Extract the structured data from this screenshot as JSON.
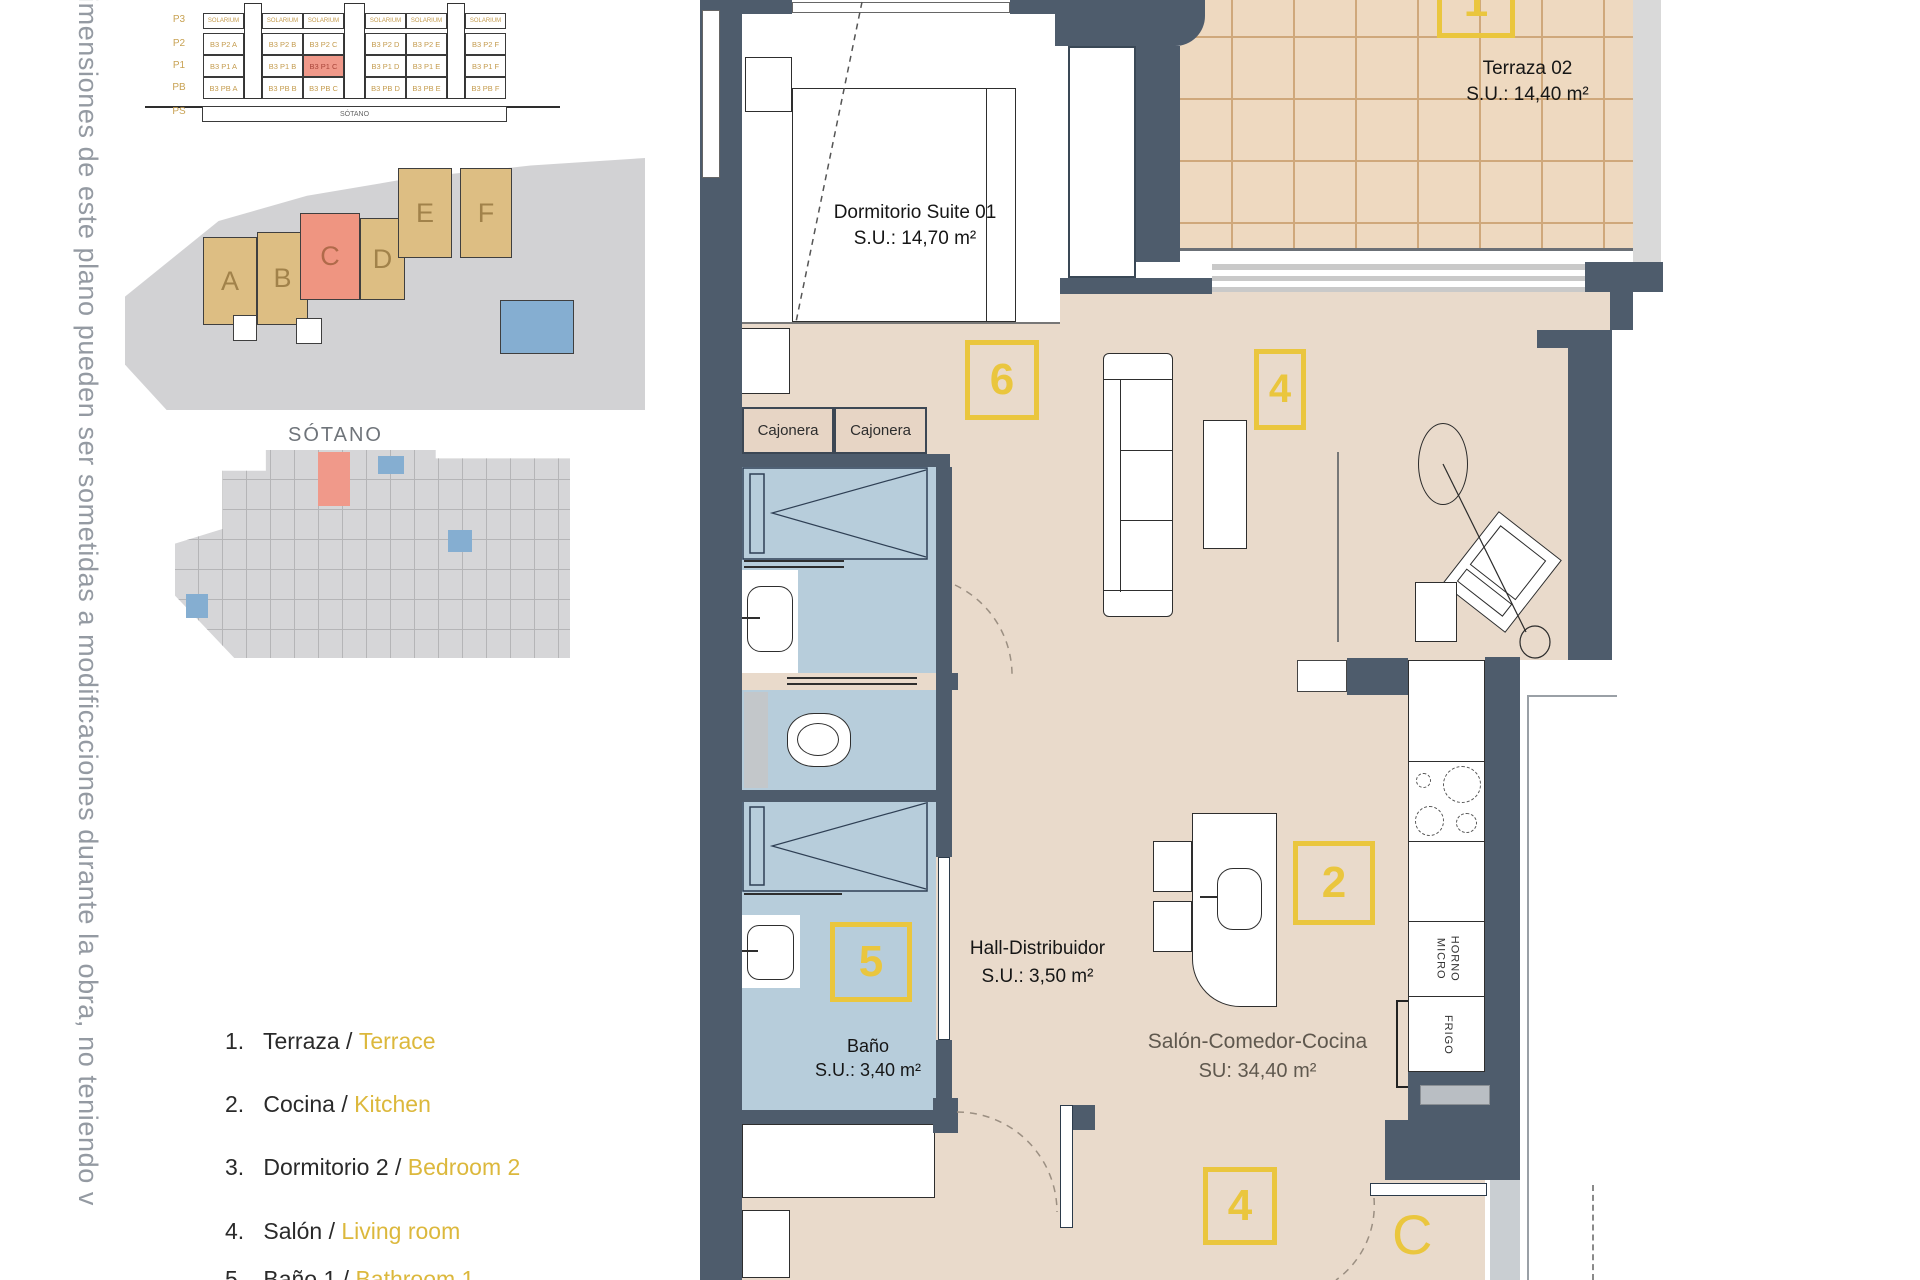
{
  "note_vertical": "imensiones de este plano pueden ser sometidas a modificaciones durante la obra, no teniendo v",
  "elevation": {
    "row_labels": [
      "P3",
      "P2",
      "P1",
      "PB",
      "PS"
    ],
    "solarium": "SOLARIUM",
    "sotano": "SÓTANO",
    "p2": [
      "B3 P2 A",
      "B3 P2 B",
      "B3 P2 C",
      "B3 P2 D",
      "B3 P2 E",
      "B3 P2 F"
    ],
    "p1": [
      "B3 P1 A",
      "B3 P1 B",
      "B3 P1 C",
      "B3 P1 D",
      "B3 P1 E",
      "B3 P1 F"
    ],
    "pb": [
      "B3 PB A",
      "B3 PB B",
      "B3 PB C",
      "B3 PB D",
      "B3 PB E",
      "B3 PB F"
    ]
  },
  "site": {
    "buildings": [
      "A",
      "B",
      "C",
      "D",
      "E",
      "F"
    ]
  },
  "basement": {
    "label": "SÓTANO"
  },
  "legend": {
    "sep": "/",
    "items": [
      {
        "num": "1.",
        "es": "Terraza",
        "en": "Terrace"
      },
      {
        "num": "2.",
        "es": "Cocina",
        "en": "Kitchen"
      },
      {
        "num": "3.",
        "es": "Dormitorio 2",
        "en": "Bedroom 2"
      },
      {
        "num": "4.",
        "es": "Salón",
        "en": "Living room"
      },
      {
        "num": "5.",
        "es": "Baño 1",
        "en": "Bathroom 1"
      }
    ]
  },
  "floor_plan": {
    "rooms": {
      "suite": {
        "name": "Dormitorio Suite 01",
        "area": "S.U.: 14,70 m²"
      },
      "terraza": {
        "name": "Terraza 02",
        "area": "S.U.: 14,40 m²"
      },
      "hall": {
        "name": "Hall-Distribuidor",
        "area": "S.U.: 3,50 m²"
      },
      "bano": {
        "name": "Baño",
        "area": "S.U.: 3,40 m²"
      },
      "salon": {
        "name": "Salón-Comedor-Cocina",
        "area": "SU: 34,40 m²"
      }
    },
    "markers": {
      "terraza": "1",
      "suite": "6",
      "salon_top": "4",
      "cocina": "2",
      "bano": "5",
      "salon_bottom": "4",
      "entrance_door": "C"
    },
    "fittings": {
      "cajonera": "Cajonera",
      "horno": "HORNO",
      "micro": "MICRO",
      "frigo": "FRIGO"
    }
  },
  "colors": {
    "wall": "#4e5c6c",
    "floor": "#e9dacb",
    "terrace": "#eed9c0",
    "terrace_grid": "#cfa87b",
    "wet_room": "#b7cddb",
    "marker_gold": "#eac63e",
    "legend_gold": "#dcb83c",
    "highlight_salmon": "#f0998a",
    "building_tan": "#ddbe83",
    "site_gray": "#d2d2d4"
  }
}
